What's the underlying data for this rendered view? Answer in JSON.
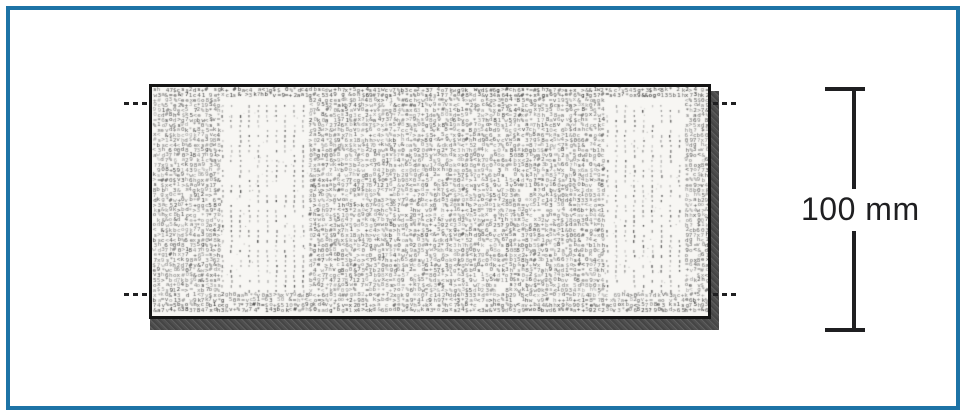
{
  "figure": {
    "dimension_label": "100 mm",
    "colors": {
      "paper": "#ffffff",
      "frame": "#1d73a6",
      "line": "#1f1f21",
      "specimen_border": "#141414",
      "shadow": "#4e4e4e",
      "texture_bg": "#f7f6f3"
    },
    "specimen": {
      "texture": {
        "charset": "0123456789acehkosvwx#%&$+<>*=?bdg",
        "cell_w": 4,
        "row_h": 5,
        "font_px": 6,
        "band_top": 13,
        "band_bottom": 205,
        "column_pitch": 9,
        "bands": [
          {
            "x": 66,
            "w": 91
          },
          {
            "x": 451,
            "w": 80
          }
        ]
      }
    }
  }
}
